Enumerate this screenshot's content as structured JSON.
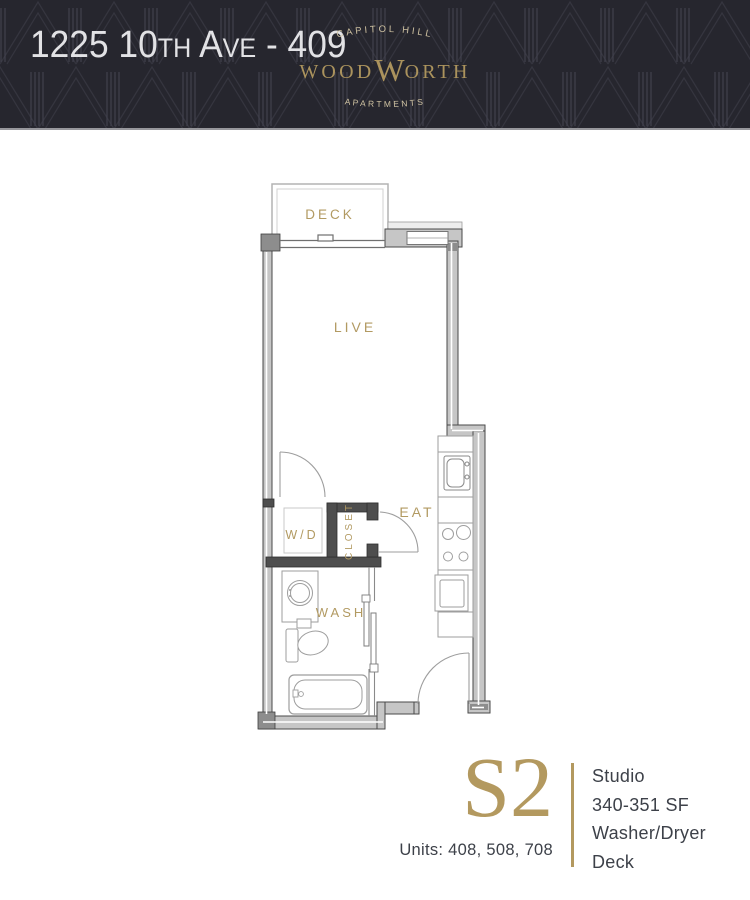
{
  "header": {
    "unit_title": "1225 10th Ave - 409",
    "logo": {
      "location": "CAPITOL HILL",
      "brand_pre": "WOOD",
      "brand_w": "W",
      "brand_post": "ORTH",
      "type": "APARTMENTS"
    }
  },
  "floorplan": {
    "labels": {
      "deck": "DECK",
      "live": "LIVE",
      "eat": "EAT",
      "washer_dryer": "W/D",
      "closet": "CLOSET",
      "wash": "WASH"
    }
  },
  "info": {
    "plan_code": "S2",
    "units": "Units: 408, 508, 708",
    "features": [
      "Studio",
      "340-351 SF",
      "Washer/Dryer",
      "Deck"
    ]
  },
  "colors": {
    "header_bg": "#26262e",
    "gold": "#b3995f",
    "label_gold": "#b29a62",
    "cream": "#cfc2a2",
    "ink": "#3d4149",
    "wall_fill": "#c6c6c6",
    "wall_dark": "#4e4e4e",
    "title_text": "#e2e2e5"
  }
}
